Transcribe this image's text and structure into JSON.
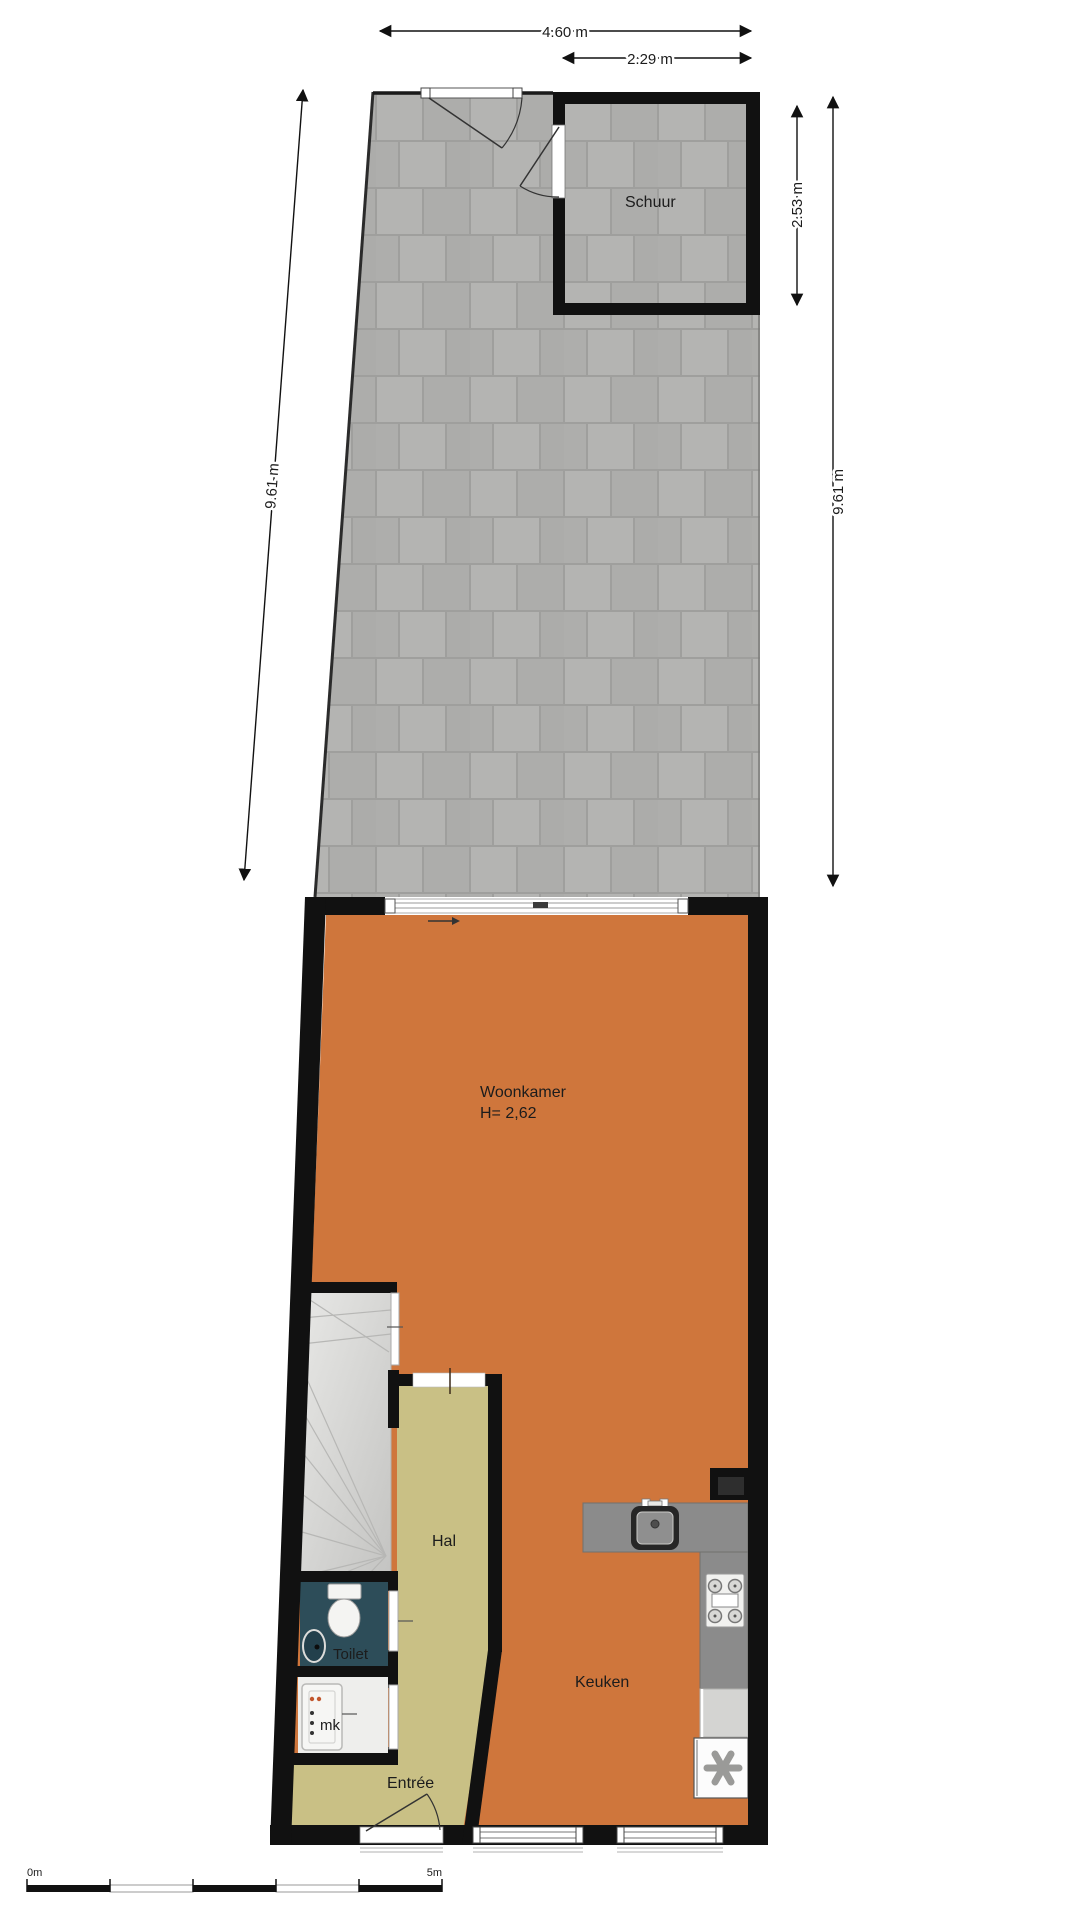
{
  "rooms": {
    "schuur": "Schuur",
    "woonkamer": "Woonkamer",
    "woonkamer_height": "H= 2,62",
    "hal": "Hal",
    "toilet": "Toilet",
    "meterkast": "mk",
    "entree": "Entrée",
    "keuken": "Keuken"
  },
  "dimensions": {
    "garden_top_width": "4.60 m",
    "schuur_width": "2.29 m",
    "schuur_height": "2.53 m",
    "garden_depth_left": "9.61 m",
    "garden_depth_right": "9.61 m"
  },
  "scale_bar": {
    "start_label": "0m",
    "end_label": "5m"
  },
  "colors": {
    "wall": "#111111",
    "living_floor": "#cf763c",
    "hall_floor": "#c9c085",
    "toilet_floor": "#2d4d59",
    "stairs": "#d6d6d4",
    "counter": "#8b8b8b",
    "paver_tile": "#b3b3b1",
    "paver_joint": "#9f9f9d",
    "background": "#ffffff"
  }
}
